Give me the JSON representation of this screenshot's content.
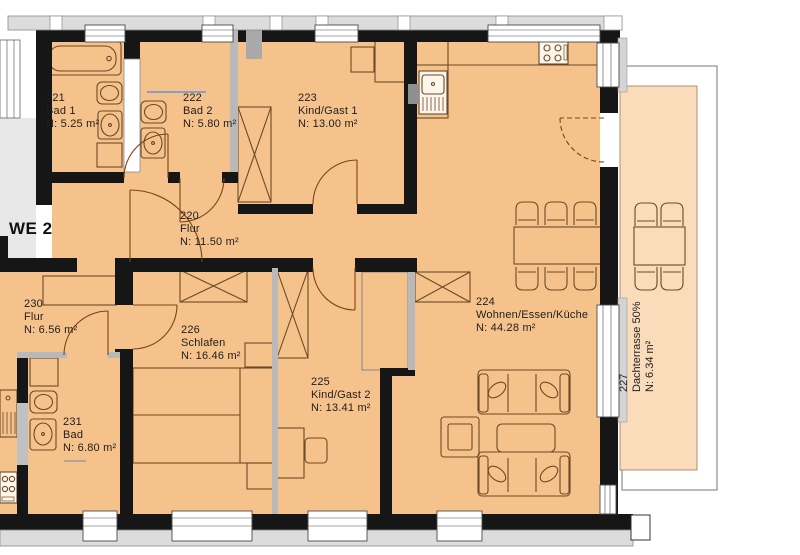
{
  "unit": {
    "label": "WE 2"
  },
  "rooms": [
    {
      "number": "221",
      "name": "Bad 1",
      "area": "N: 5.25 m²"
    },
    {
      "number": "222",
      "name": "Bad 2",
      "area": "N: 5.80 m²"
    },
    {
      "number": "223",
      "name": "Kind/Gast 1",
      "area": "N: 13.00 m²"
    },
    {
      "number": "220",
      "name": "Flur",
      "area": "N: 11.50 m²"
    },
    {
      "number": "224",
      "name": "Wohnen/Essen/Küche",
      "area": "N: 44.28 m²"
    },
    {
      "number": "225",
      "name": "Kind/Gast 2",
      "area": "N: 13.41 m²"
    },
    {
      "number": "226",
      "name": "Schlafen",
      "area": "N: 16.46 m²"
    },
    {
      "number": "230",
      "name": "Flur",
      "area": "N: 6.56 m²"
    },
    {
      "number": "231",
      "name": "Bad",
      "area": "N: 6.80 m²"
    },
    {
      "number": "227",
      "name": "Dachterrasse 50%",
      "area": "N: 6.34 m²"
    }
  ],
  "colors": {
    "room_fill": "#f6c28c",
    "terrace_fill": "#fbdcba",
    "wall": "#161616",
    "interior_wall_gray": "#b9b9b9",
    "parapet_gray": "#dcdcdc",
    "staircase_gray": "#e8e8e8",
    "furniture_stroke": "#6b4a26",
    "door_arc": "#7a4418",
    "shower_line": "#8d9ec4"
  }
}
